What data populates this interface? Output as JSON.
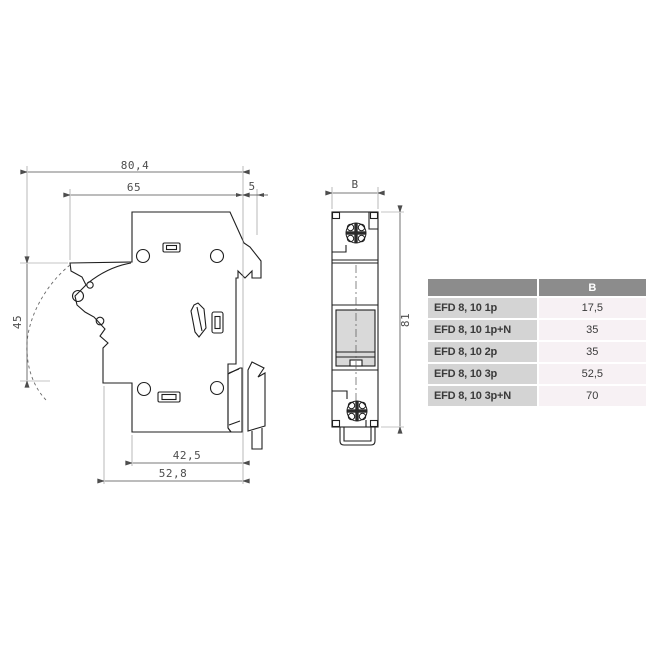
{
  "side_view": {
    "dims": {
      "total_depth": "80,4",
      "body_depth": "65",
      "rail_clearance": "5",
      "handle_travel": "45",
      "base_width": "42,5",
      "lower_depth": "52,8"
    }
  },
  "front_view": {
    "dims": {
      "width": "B",
      "height": "81"
    }
  },
  "table": {
    "header_b": "B",
    "rows": [
      {
        "product": "EFD 8, 10 1p",
        "b": "17,5"
      },
      {
        "product": "EFD 8, 10 1p+N",
        "b": "35"
      },
      {
        "product": "EFD 8, 10 2p",
        "b": "35"
      },
      {
        "product": "EFD 8, 10 3p",
        "b": "52,5"
      },
      {
        "product": "EFD 8, 10 3p+N",
        "b": "70"
      }
    ],
    "colors": {
      "header_bg": "#8c8c8c",
      "header_text": "#ffffff",
      "product_bg": "#d4d4d4",
      "value_bg": "#f7f1f4",
      "text": "#3a3a3a"
    }
  }
}
